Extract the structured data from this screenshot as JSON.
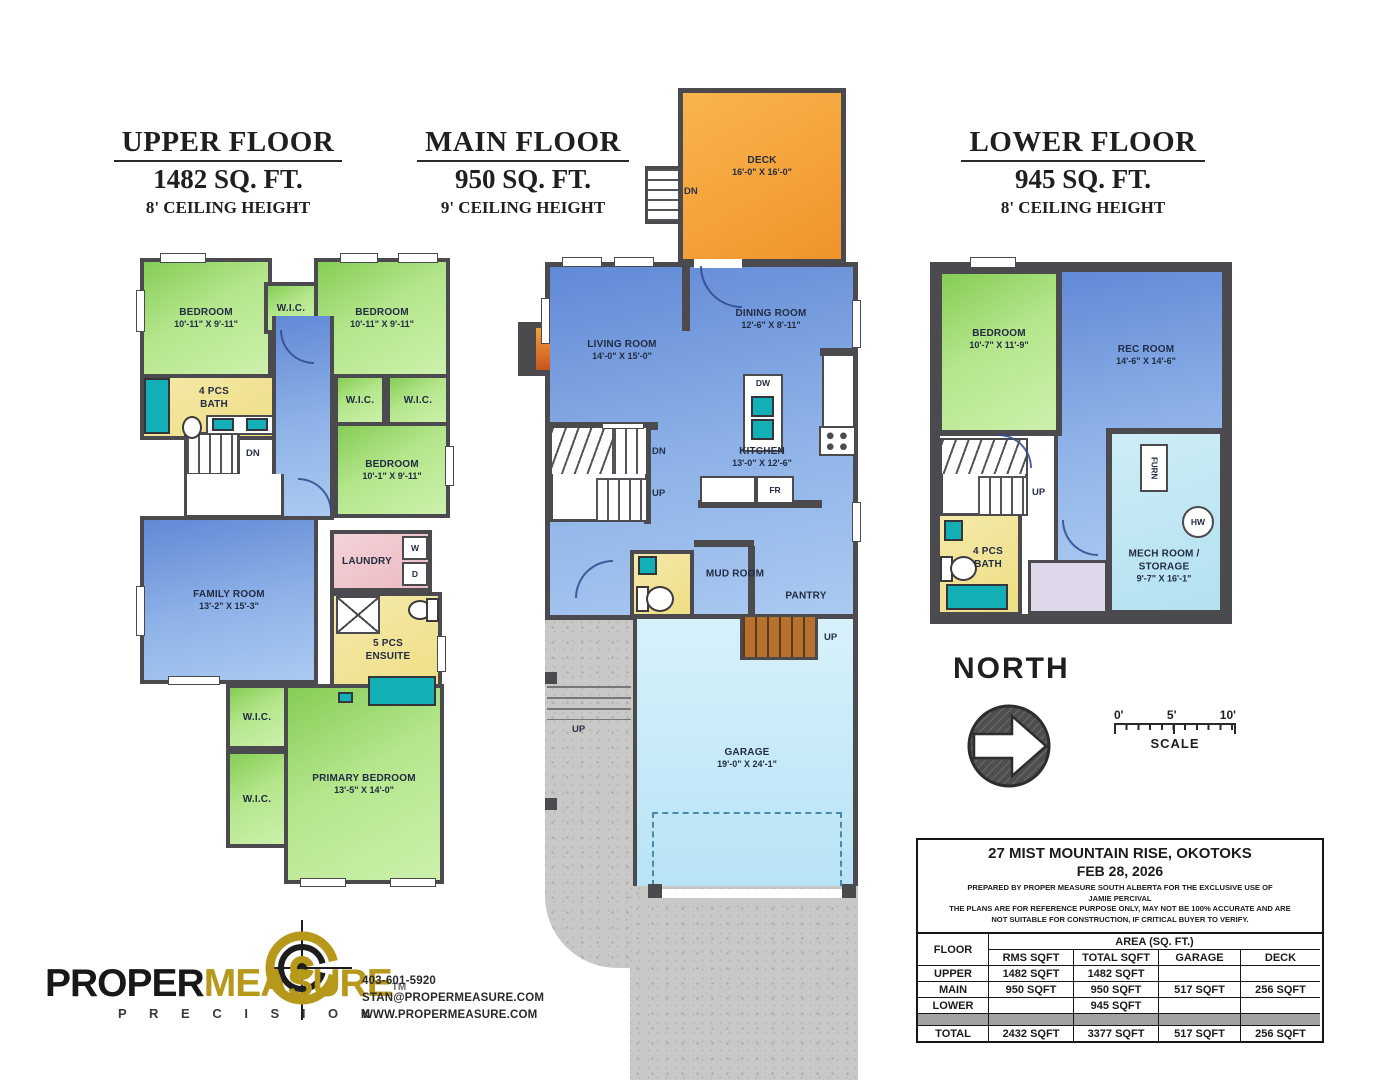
{
  "upper": {
    "title": "UPPER FLOOR",
    "area": "1482 SQ. FT.",
    "ceiling": "8' CEILING HEIGHT",
    "rooms": {
      "bed_tl": {
        "name": "BEDROOM",
        "dims": "10'-11\" X 9'-11\""
      },
      "bed_tr": {
        "name": "BEDROOM",
        "dims": "10'-11\" X 9'-11\""
      },
      "bed_mid": {
        "name": "BEDROOM",
        "dims": "10'-1\" X 9'-11\""
      },
      "wic": "W.I.C.",
      "bath": "4 PCS BATH",
      "family": {
        "name": "FAMILY ROOM",
        "dims": "13'-2\" X 15'-3\""
      },
      "laundry": "LAUNDRY",
      "washer": "W",
      "dryer": "D",
      "ensuite": "5 PCS ENSUITE",
      "primary": {
        "name": "PRIMARY BEDROOM",
        "dims": "13'-5\" X 14'-0\""
      },
      "dn": "DN"
    }
  },
  "main": {
    "title": "MAIN FLOOR",
    "area": "950 SQ. FT.",
    "ceiling": "9' CEILING HEIGHT",
    "rooms": {
      "deck": {
        "name": "DECK",
        "dims": "16'-0\" X 16'-0\""
      },
      "living": {
        "name": "LIVING ROOM",
        "dims": "14'-0\" X 15'-0\""
      },
      "dining": {
        "name": "DINING ROOM",
        "dims": "12'-6\" X 8'-11\""
      },
      "kitchen": {
        "name": "KITCHEN",
        "dims": "13'-0\" X 12'-6\""
      },
      "mud": "MUD ROOM",
      "pantry": "PANTRY",
      "garage": {
        "name": "GARAGE",
        "dims": "19'-0\" X 24'-1\""
      },
      "dw": "DW",
      "fr": "FR",
      "dn": "DN",
      "up": "UP"
    }
  },
  "lower": {
    "title": "LOWER FLOOR",
    "area": "945 SQ. FT.",
    "ceiling": "8' CEILING HEIGHT",
    "rooms": {
      "bedroom": {
        "name": "BEDROOM",
        "dims": "10'-7\" X 11'-9\""
      },
      "rec": {
        "name": "REC ROOM",
        "dims": "14'-6\" X 14'-6\""
      },
      "bath": "4 PCS BATH",
      "mech1": "MECH ROOM /",
      "mech2": "STORAGE",
      "mech_dims": "9'-7\" X 16'-1\"",
      "furn": "FURN",
      "hw": "HW",
      "up": "UP"
    }
  },
  "compass": {
    "north": "NORTH"
  },
  "scale": {
    "t0": "0'",
    "t5": "5'",
    "t10": "10'",
    "label": "SCALE"
  },
  "info_table": {
    "address": "27 MIST MOUNTAIN RISE, OKOTOKS",
    "date": "FEB 28, 2026",
    "prepared1": "PREPARED BY PROPER MEASURE SOUTH ALBERTA FOR THE EXCLUSIVE USE OF",
    "prepared2": "JAMIE PERCIVAL",
    "disclaimer1": "THE PLANS ARE FOR REFERENCE PURPOSE ONLY, MAY NOT BE 100% ACCURATE AND ARE",
    "disclaimer2": "NOT SUITABLE FOR CONSTRUCTION, IF CRITICAL BUYER TO VERIFY.",
    "floor_header": "FLOOR",
    "area_header": "AREA (SQ. FT.)",
    "col_rms": "RMS SQFT",
    "col_total": "TOTAL SQFT",
    "col_garage": "GARAGE",
    "col_deck": "DECK",
    "rows": [
      {
        "floor": "UPPER",
        "rms": "1482 SQFT",
        "total": "1482 SQFT",
        "garage": "",
        "deck": ""
      },
      {
        "floor": "MAIN",
        "rms": "950 SQFT",
        "total": "950 SQFT",
        "garage": "517 SQFT",
        "deck": "256 SQFT"
      },
      {
        "floor": "LOWER",
        "rms": "",
        "total": "945 SQFT",
        "garage": "",
        "deck": ""
      },
      {
        "floor": "TOTAL",
        "rms": "2432 SQFT",
        "total": "3377 SQFT",
        "garage": "517 SQFT",
        "deck": "256 SQFT"
      }
    ]
  },
  "logo": {
    "part1": "PROPER",
    "part2": "MEASURE",
    "tm": "TM",
    "tagline": "P R E C I S I O N",
    "phone": "403-601-5920",
    "email": "STAN@PROPERMEASURE.COM",
    "website": "WWW.PROPERMEASURE.COM"
  },
  "colors": {
    "wall": "#4b4a4e",
    "accent_gold": "#b6981b",
    "deck_orange": "#f0932b",
    "room_green": "#9edd6e",
    "room_blue": "#6f95d8",
    "garage_blue": "#c5e9f7"
  }
}
